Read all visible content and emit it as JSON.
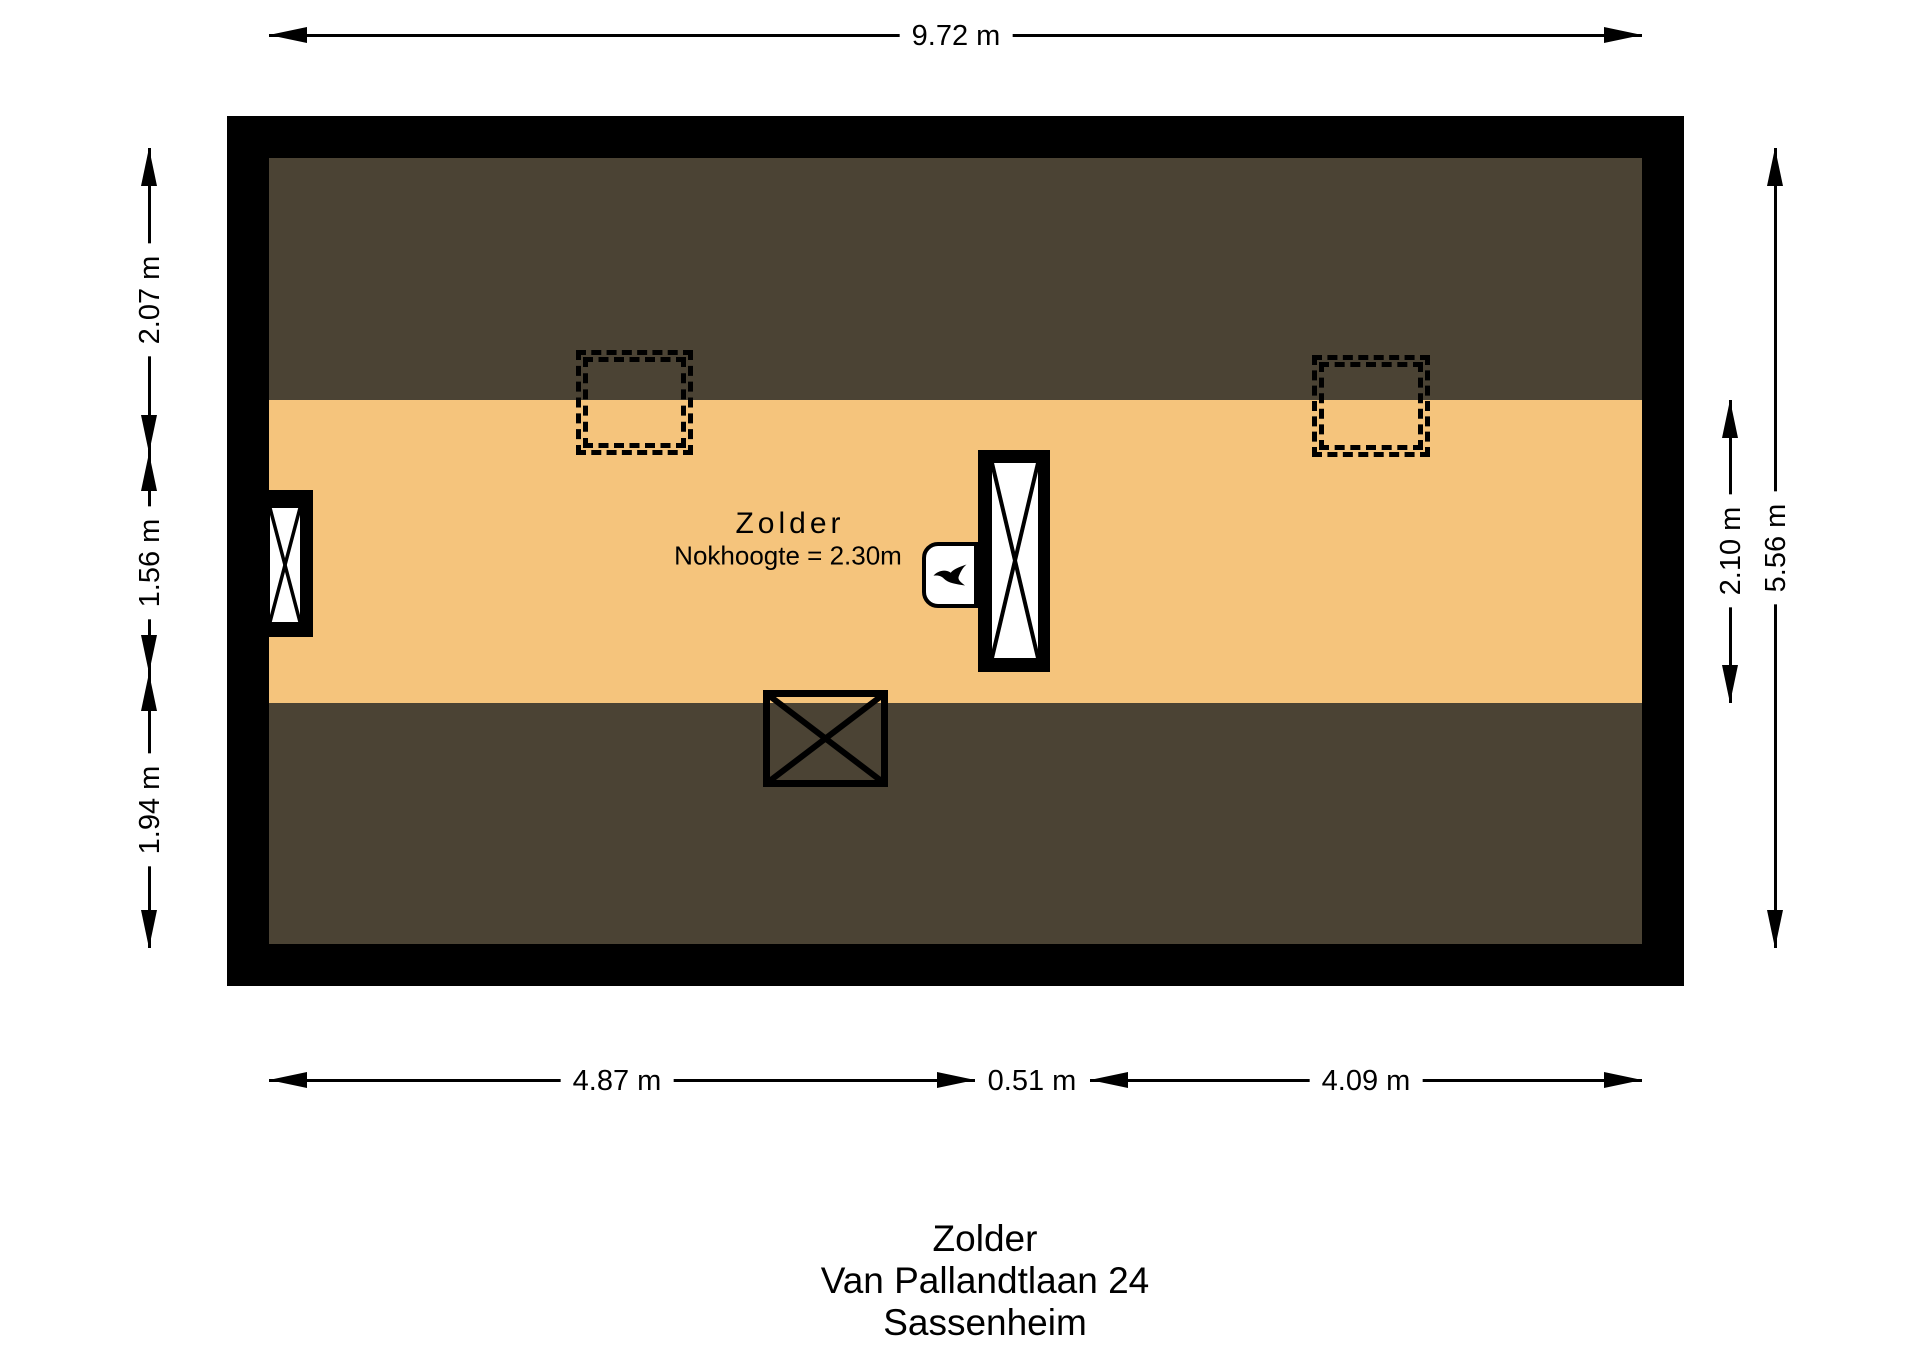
{
  "colors": {
    "wall": "#000000",
    "roof_slope": "#4B4334",
    "floor": "#F5C47C",
    "background": "#FFFFFF",
    "line": "#000000"
  },
  "dimensions": {
    "top": {
      "width": "9.72 m"
    },
    "bottom": {
      "left": "4.87 m",
      "middle": "0.51 m",
      "right": "4.09 m"
    },
    "left": {
      "top": "2.07 m",
      "middle": "1.56 m",
      "bottom": "1.94 m"
    },
    "right": {
      "inner": "2.10 m",
      "total": "5.56 m"
    }
  },
  "room": {
    "name": "Zolder",
    "ridge_height": "Nokhoogte = 2.30m"
  },
  "title": {
    "line1": "Zolder",
    "line2": "Van Pallandtlaan 24",
    "line3": "Sassenheim"
  },
  "icons": {
    "boiler_flame": "flame-icon"
  }
}
